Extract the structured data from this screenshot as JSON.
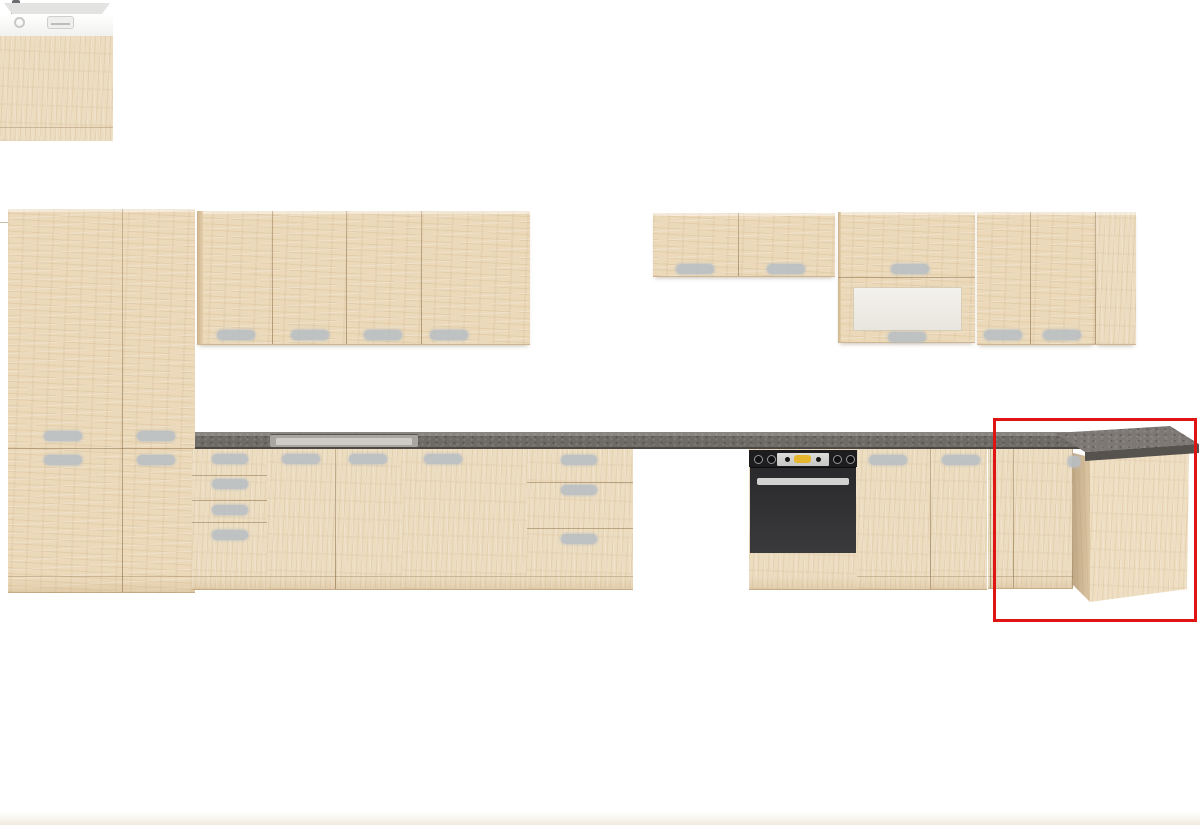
{
  "meta": {
    "type": "product-render",
    "subject": "modular kitchen cabinet set in light oak with dark grey worktop on white background",
    "background_color": "#ffffff"
  },
  "palette": {
    "wood_light": "#ebd9ba",
    "wood_side_panel": "#ecdcc0",
    "wood_shadow": "#d9c09c",
    "wood_edge_line": "#7a5830",
    "worktop_grey": "#6e6a66",
    "worktop_top_surface": "#7d7873",
    "worktop_front_edge": "#56524e",
    "handle_grey": "#b9bfc4",
    "dishwasher_white": "#ffffff",
    "dishwasher_silver": "#e3e3e1",
    "oven_black": "#1d1d1f",
    "oven_door_grey": "#323234",
    "oven_handle_silver": "#d2d2d0",
    "oven_display_yellow": "#e6b52e",
    "frosted_glass": "#f0eee8",
    "faucet_grey": "#8f969b",
    "highlight_red": "#de1512"
  },
  "highlight": {
    "shape": "rectangle",
    "marks": "corner-base-cabinet",
    "x": 993,
    "y": 418,
    "width": 204,
    "height": 204,
    "border_px": 3,
    "color": "#de1512"
  },
  "components": [
    {
      "id": "tall-pantry-cabinet",
      "description": "tall two-column larder cabinet with four doors and grey pill handles"
    },
    {
      "id": "wall-cabinet-row-left",
      "description": "four-door wall cabinet row above the sink run"
    },
    {
      "id": "mixer-tap",
      "description": "tall grey spring-neck kitchen mixer tap"
    },
    {
      "id": "inset-sink",
      "description": "inset sink recessed into the worktop"
    },
    {
      "id": "worktop",
      "description": "dark grey stone-effect worktop along the base run"
    },
    {
      "id": "drawer-unit-left",
      "description": "four-drawer base unit"
    },
    {
      "id": "sink-base-cabinet",
      "description": "two-door sink base cabinet"
    },
    {
      "id": "base-cabinet-wide",
      "description": "wide single-door base cabinet"
    },
    {
      "id": "drawer-unit-right",
      "description": "three-drawer base unit"
    },
    {
      "id": "dishwasher",
      "description": "semi-integrated dishwasher with white control panel and wood furniture door"
    },
    {
      "id": "built-in-oven",
      "description": "black built-in oven with knobs, yellow clock display and silver handle"
    },
    {
      "id": "base-cabinet-pair",
      "description": "two single-door base cabinets right of the oven"
    },
    {
      "id": "corner-base-cabinet",
      "description": "corner base unit with angled door front and deep side panel, highlighted in red"
    },
    {
      "id": "wall-cabinet-row-right",
      "description": "right wall run: two short cabinets, frosted-glass flap cabinet, two tall doors and end panel"
    },
    {
      "id": "highlight-box",
      "description": "red rectangle annotation marking the corner base cabinet"
    }
  ]
}
